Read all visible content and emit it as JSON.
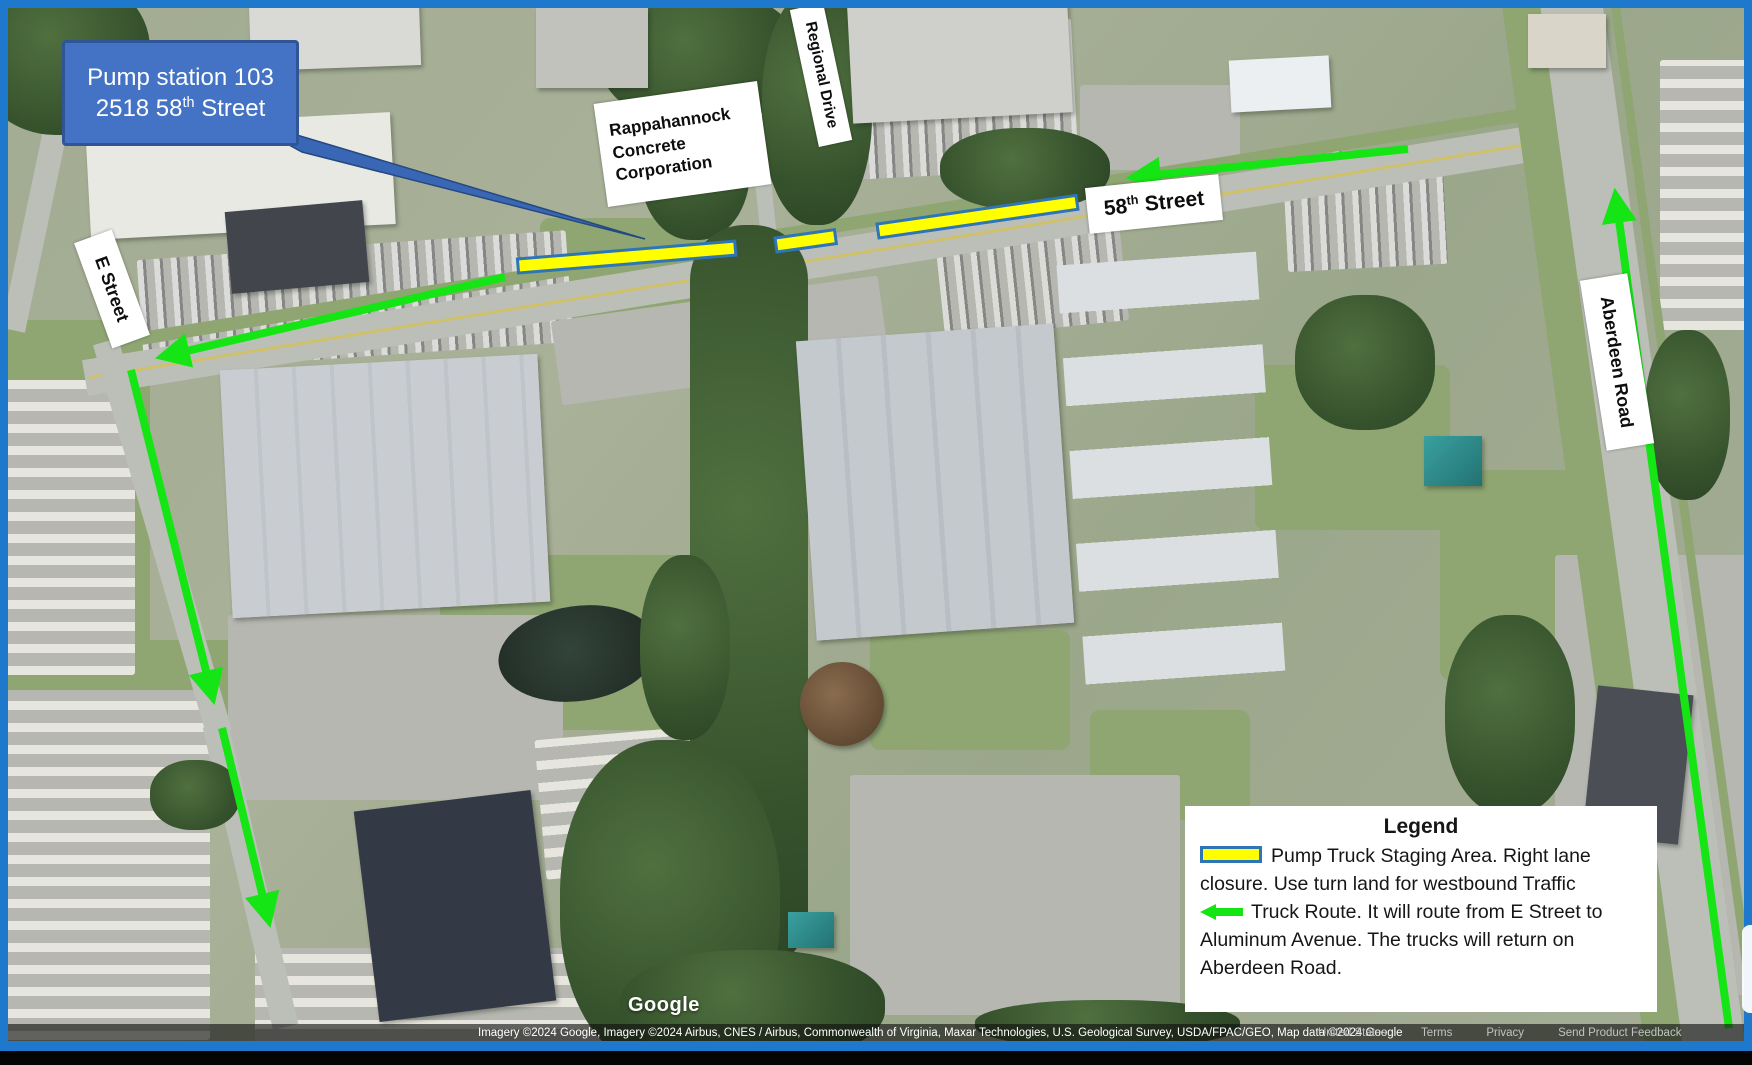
{
  "callout": {
    "line1": "Pump station 103",
    "line2_num": "2518 58",
    "line2_sup": "th",
    "line2_rest": " Street"
  },
  "street_labels": {
    "rappahannock": {
      "lines": [
        "Rappahannock",
        "Concrete",
        "Corporation"
      ]
    },
    "regional_drive": "Regional Drive",
    "street58": {
      "num": "58",
      "sup": "th",
      "rest": " Street"
    },
    "e_street": "E Street",
    "aberdeen": "Aberdeen Road"
  },
  "legend": {
    "title": "Legend",
    "staging_text": "Pump Truck Staging Area. Right lane closure. Use turn land for westbound Traffic",
    "route_text": "Truck Route.  It will route from E Street to Aluminum Avenue.  The trucks will return on Aberdeen Road."
  },
  "footer": {
    "logo": "Google",
    "attribution": "Imagery ©2024 Google, Imagery ©2024 Airbus, CNES / Airbus, Commonwealth of Virginia, Maxar Technologies, U.S. Geological Survey, USDA/FPAC/GEO, Map data ©2024 Google",
    "links": [
      "United States",
      "Terms",
      "Privacy",
      "Send Product Feedback"
    ]
  },
  "colors": {
    "route_green": "#15e515",
    "staging_fill": "#ffff00",
    "staging_border": "#2e75b6",
    "callout_fill": "#4472c4",
    "callout_border": "#2f5597",
    "frame_blue": "#1e78cc"
  }
}
